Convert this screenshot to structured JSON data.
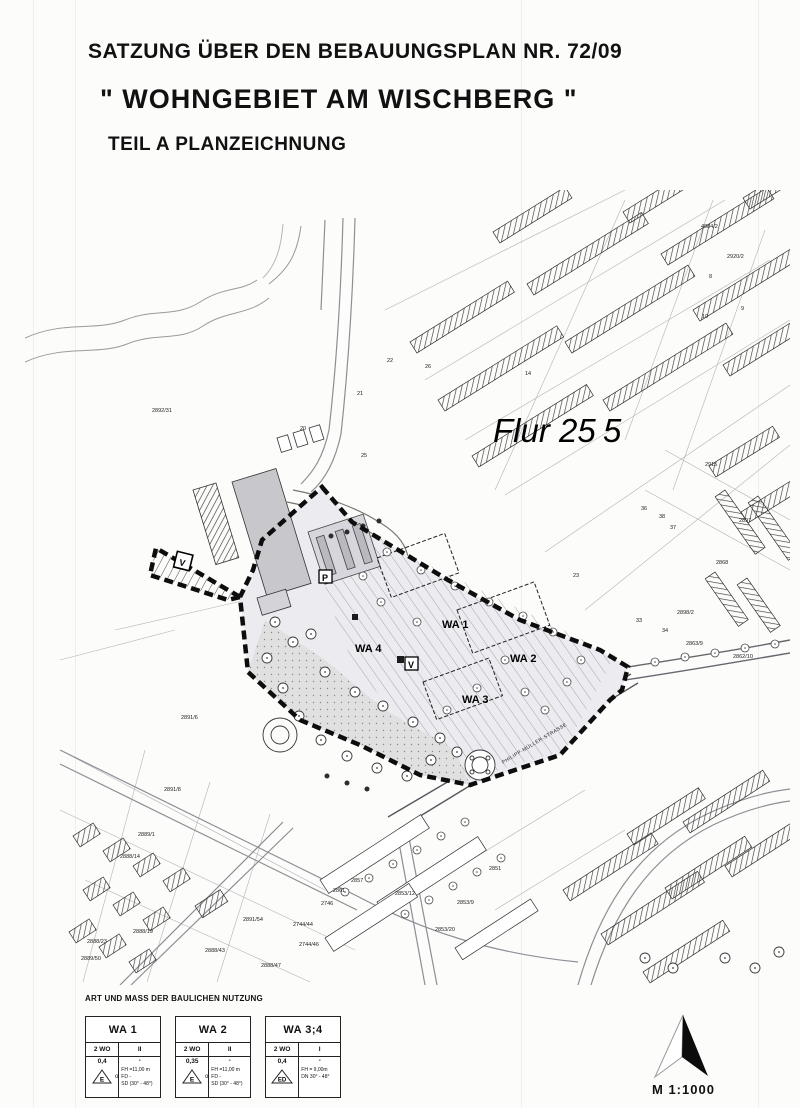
{
  "header": {
    "line1": "SATZUNG ÜBER DEN BEBAUUNGSPLAN NR. 72/09",
    "line2": "\" WOHNGEBIET AM WISCHBERG \"",
    "line3": "TEIL A  PLANZEICHNUNG"
  },
  "map": {
    "flur_label": "Flur 25",
    "flur_ghost": "5",
    "street_label": "PHILIPP-MÜLLER-STRASSE",
    "zone_labels": {
      "wa1": "WA 1",
      "wa2": "WA 2",
      "wa3": "WA 3",
      "wa4": "WA 4"
    },
    "markers": {
      "v1": "V",
      "v2": "V",
      "p": "P"
    },
    "parcel_labels": [
      "2892/31",
      "21",
      "22",
      "20",
      "26",
      "25",
      "14",
      "23",
      "2920/2",
      "4884/2",
      "8",
      "9",
      "10",
      "2915",
      "2897",
      "36",
      "38",
      "37",
      "33",
      "34",
      "2868",
      "2898/2",
      "2863/9",
      "2862/10",
      "2891/6",
      "2891/8",
      "2889/1",
      "2888/14",
      "2888/19",
      "2888/23",
      "2889/50",
      "2888/43",
      "2888/47",
      "2891/54",
      "2746",
      "2744/44",
      "2744/46",
      "2857",
      "2861",
      "2853/12",
      "2853/9",
      "2853/20",
      "2851"
    ]
  },
  "legend": {
    "title": "ART UND MASS DER BAULICHEN NUTZUNG",
    "tables": [
      {
        "name": "WA 1",
        "wo": "2 WO",
        "floors": "II",
        "grz": "0,4",
        "dash": "-",
        "tri": "E",
        "circle": "o",
        "lines": [
          "FH =11,00 m",
          "FD -",
          "SD (30° - 48°)"
        ]
      },
      {
        "name": "WA 2",
        "wo": "2 WO",
        "floors": "II",
        "grz": "0,35",
        "dash": "-",
        "tri": "E",
        "circle": "o",
        "lines": [
          "FH =11,00 m",
          "FD -",
          "SD (30° - 48°)"
        ]
      },
      {
        "name": "WA 3;4",
        "wo": "2 WO",
        "floors": "I",
        "grz": "0,4",
        "dash": "-",
        "tri": "ED",
        "circle": "",
        "lines": [
          "FH  = 9,00m",
          "DN 30° - 48°",
          ""
        ]
      }
    ]
  },
  "scale_label": "M  1:1000"
}
